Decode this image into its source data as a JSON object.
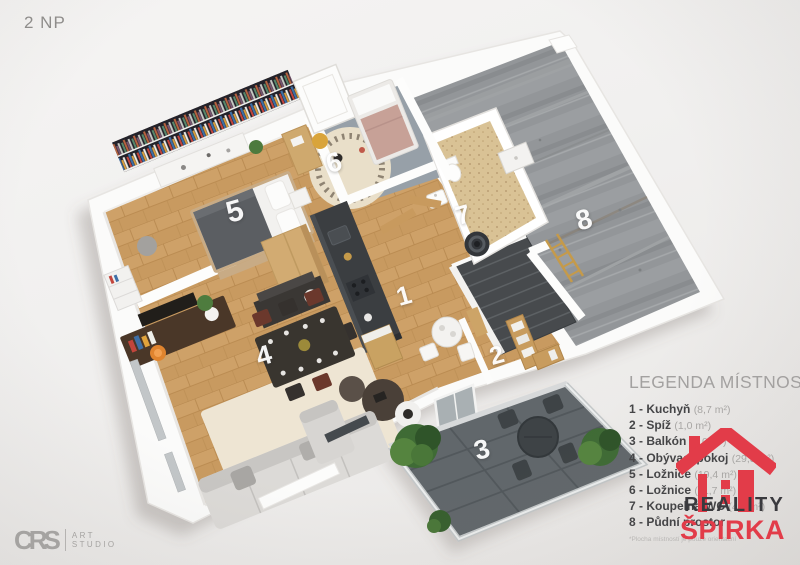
{
  "page": {
    "floor_label": "2 NP",
    "footnote": "*Plocha místností je pouze orientační"
  },
  "legend": {
    "title": "LEGENDA MÍSTNOSTÍ",
    "items": [
      {
        "num": "1",
        "name": "Kuchyň",
        "area": "(8,7 m²)"
      },
      {
        "num": "2",
        "name": "Spíž",
        "area": "(1,0 m²)"
      },
      {
        "num": "3",
        "name": "Balkón",
        "area": "(8,0 m²)"
      },
      {
        "num": "4",
        "name": "Obývací pokoj",
        "area": "(29,3 m²)"
      },
      {
        "num": "5",
        "name": "Ložnice",
        "area": "(19,4 m²)"
      },
      {
        "num": "6",
        "name": "Ložnice",
        "area": "(11,7 m²)"
      },
      {
        "num": "7",
        "name": "Koupelna-WC",
        "area": "(4,0 m²)"
      },
      {
        "num": "8",
        "name": "Půdní prostor",
        "area": ""
      }
    ]
  },
  "agency": {
    "line1": "REALITY",
    "line2": "ŠPIRKA"
  },
  "studio": {
    "name": "CRS",
    "sub1": "ART",
    "sub2": "STUDIO"
  },
  "colors": {
    "brand_red": "#e23c49",
    "logo_dark": "#3a3a3e",
    "studio_gray": "#a5a3a1",
    "legend_text": "#454547",
    "legend_area": "#a8a6a4",
    "wood_floor": "#c89a60",
    "concrete": "#949799",
    "balcony_tile": "#61676b"
  },
  "plan": {
    "room_numbers": [
      {
        "n": "1",
        "x": 404,
        "y": 296,
        "s": 26
      },
      {
        "n": "2",
        "x": 497,
        "y": 356,
        "s": 25
      },
      {
        "n": "3",
        "x": 482,
        "y": 450,
        "s": 27
      },
      {
        "n": "4",
        "x": 264,
        "y": 356,
        "s": 27
      },
      {
        "n": "5",
        "x": 235,
        "y": 212,
        "s": 30
      },
      {
        "n": "6",
        "x": 334,
        "y": 163,
        "s": 27
      },
      {
        "n": "7",
        "x": 463,
        "y": 215,
        "s": 26
      },
      {
        "n": "8",
        "x": 584,
        "y": 220,
        "s": 28
      }
    ]
  }
}
